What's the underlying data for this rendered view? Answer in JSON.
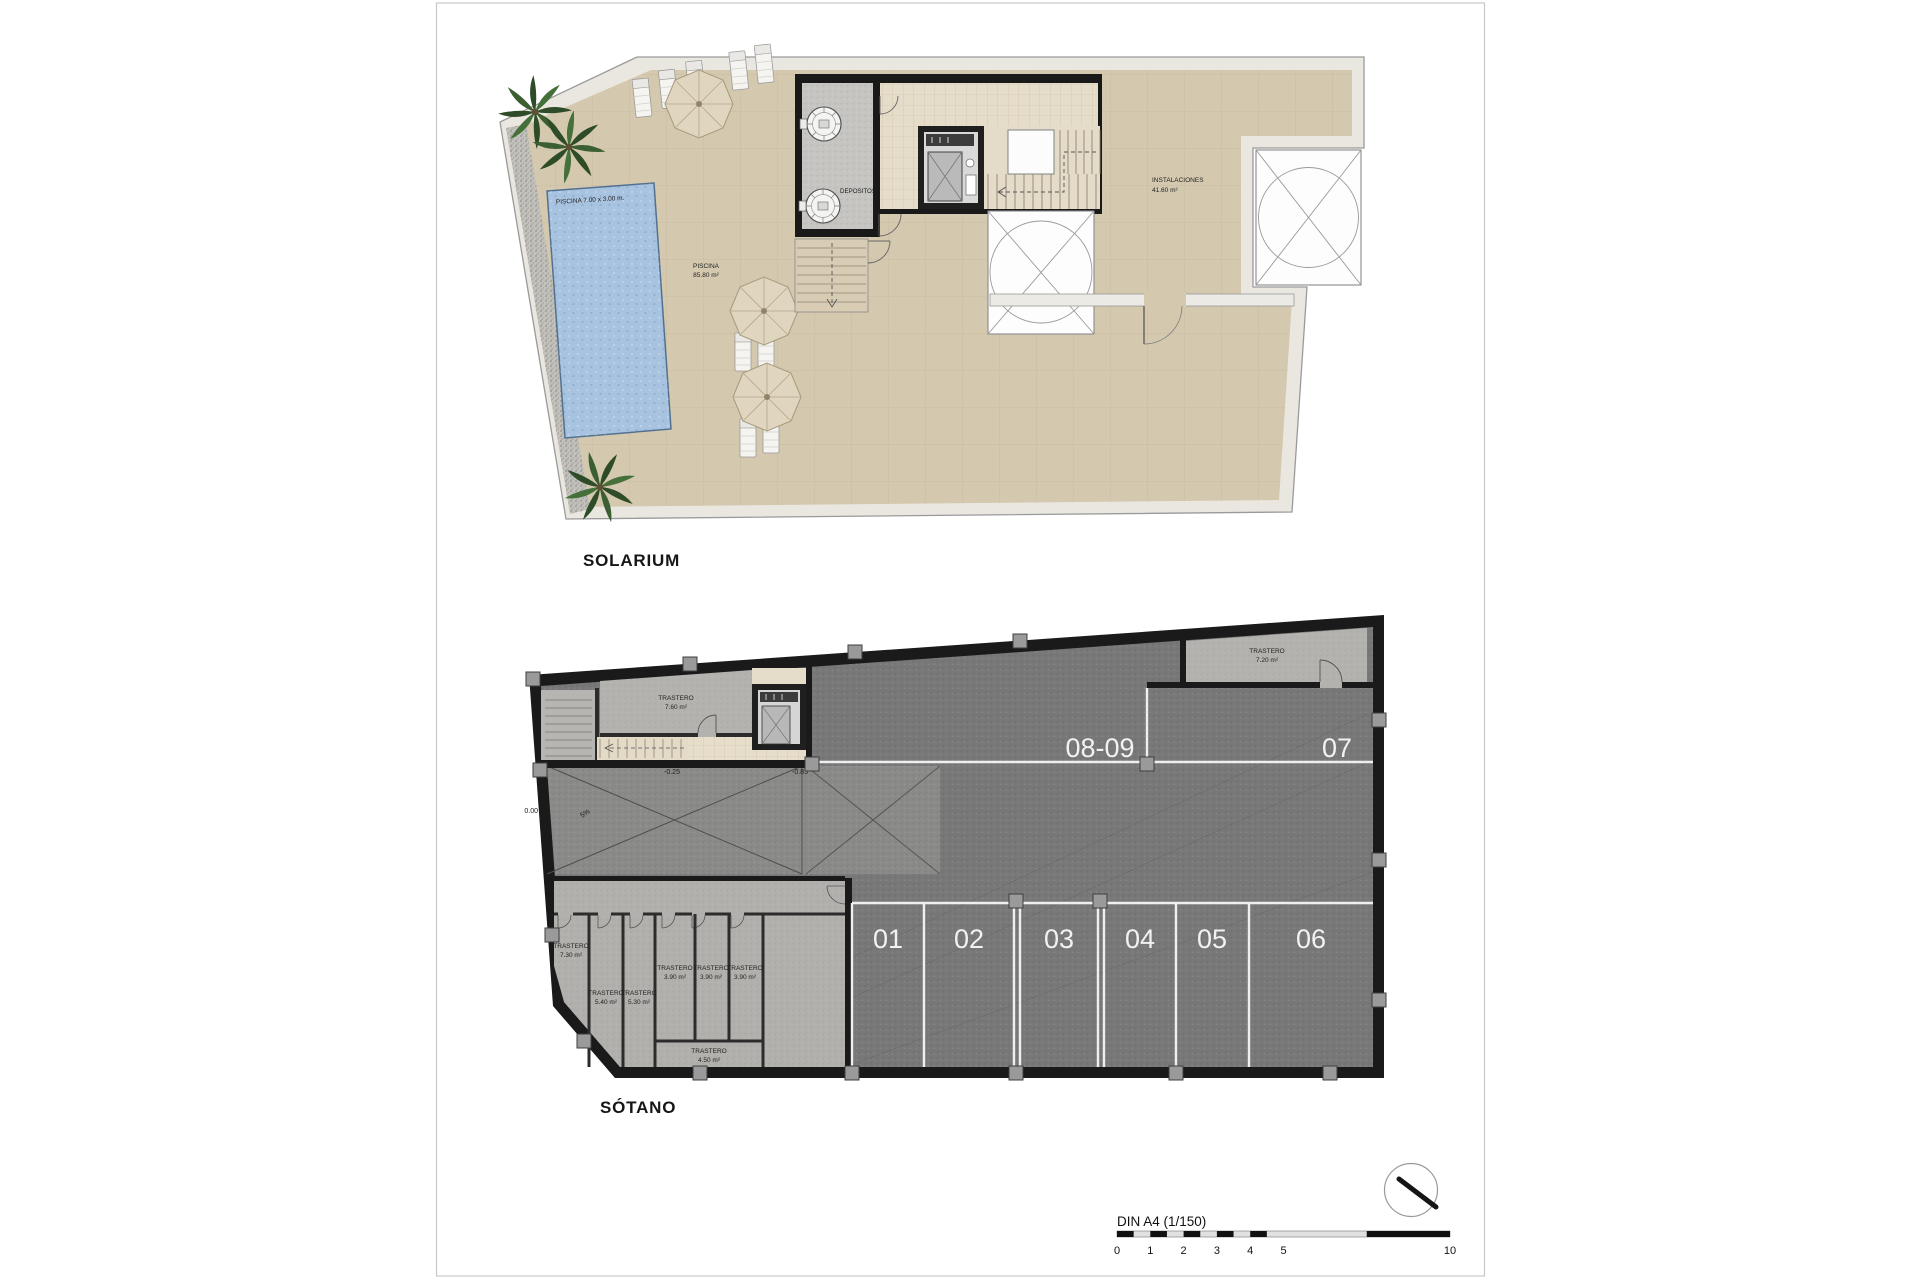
{
  "sheet": {
    "format_label": "DIN A4 (1/150)",
    "scale_ticks": [
      "0",
      "1",
      "2",
      "3",
      "4",
      "5",
      "10"
    ]
  },
  "solarium": {
    "title": "SOLARIUM",
    "pool_dimensions": "PISCINA 7.00 x 3.00 m.",
    "pool_area": {
      "name": "PISCINA",
      "value": "85.80 m²"
    },
    "tanks_room": "DEPOSITOS",
    "installations": {
      "name": "INSTALACIONES",
      "value": "41.60 m²"
    }
  },
  "sotano": {
    "title": "SÓTANO",
    "parking": [
      "08-09",
      "07",
      "01",
      "02",
      "03",
      "04",
      "05",
      "06"
    ],
    "storerooms": [
      {
        "name": "TRASTERO",
        "area": "7.60 m²"
      },
      {
        "name": "TRASTERO",
        "area": "7.20 m²"
      },
      {
        "name": "TRASTERO",
        "area": "7.30 m²"
      },
      {
        "name": "TRASTERO",
        "area": "5.40 m²"
      },
      {
        "name": "TRASTERO",
        "area": "5.30 m²"
      },
      {
        "name": "TRASTERO",
        "area": "3.90 m²"
      },
      {
        "name": "TRASTERO",
        "area": "3.90 m²"
      },
      {
        "name": "TRASTERO",
        "area": "3.90 m²"
      },
      {
        "name": "TRASTERO",
        "area": "4.50 m²"
      }
    ],
    "levels": {
      "street": "0.00",
      "ramp_upper": "-0.25",
      "ramp_lower": "-0.85",
      "slope": "5%"
    }
  }
}
